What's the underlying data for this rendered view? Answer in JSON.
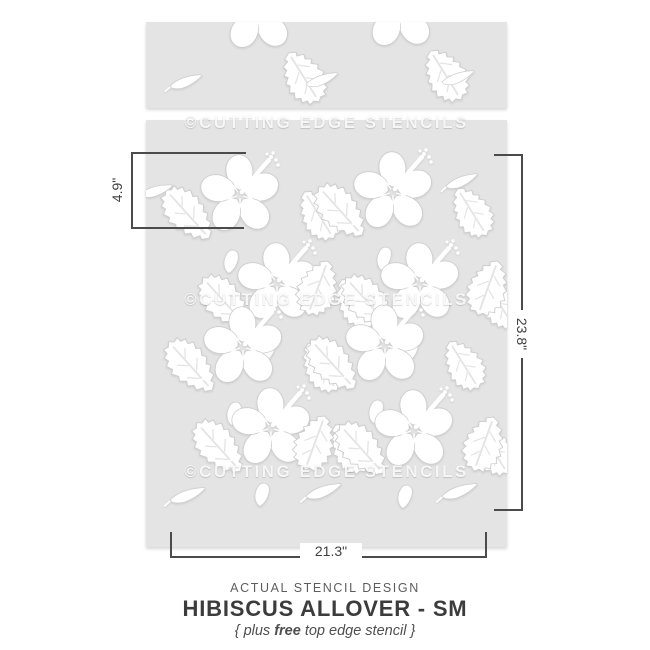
{
  "watermark": {
    "text": "©CUTTING EDGE STENCILS"
  },
  "dimensions": {
    "strip_height": "4.9\"",
    "panel_height": "23.8\"",
    "panel_width": "21.3\""
  },
  "caption": {
    "kicker": "ACTUAL STENCIL DESIGN",
    "title": "HIBISCUS ALLOVER - SM",
    "subtitle_prefix": "{ plus ",
    "subtitle_bold": "free",
    "subtitle_suffix": " top edge stencil }"
  },
  "stencil": {
    "motifs": [
      "hibiscus-flower",
      "serrated-leaf",
      "slender-leaf",
      "bud"
    ],
    "material_color": "#e4e4e4",
    "cutout_color": "#ffffff"
  },
  "colors": {
    "dimension_line": "#4b4b4b",
    "title_text": "#3c3c3c",
    "background": "#ffffff"
  }
}
